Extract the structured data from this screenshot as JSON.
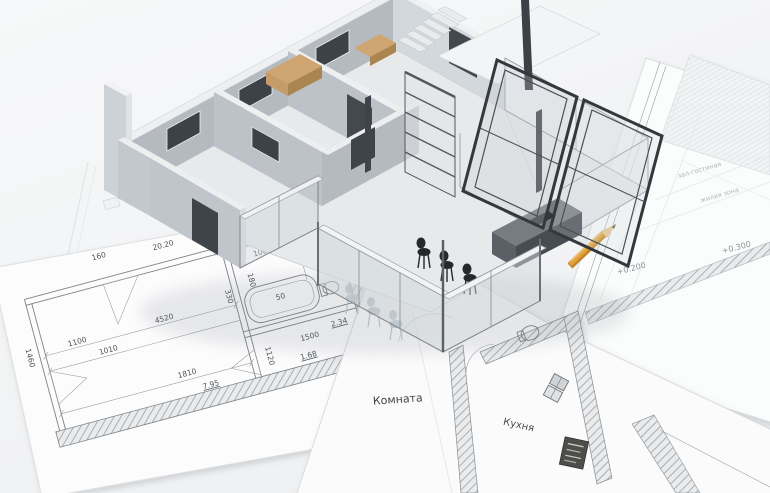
{
  "scene": {
    "colors": {
      "background": "#f4f5f6",
      "paper": "#fcfcfc",
      "plan-line": "#7d8286",
      "wall-gray": "#b4bac0",
      "wall-light": "#d3d8dc",
      "wall-top": "#edeff1",
      "window-dark": "#3d4248",
      "cabinet-tan": "#c59c68",
      "glass": "#cdd4d9",
      "frame-dark": "#34383c",
      "stool-black": "#26292c",
      "pencil-orange": "#e2a23c"
    }
  },
  "plans": {
    "left": {
      "dims": [
        "1460",
        "160",
        "20.20",
        "1100",
        "4520",
        "1010",
        "330",
        "1810",
        "7.95",
        "1120",
        "1500",
        "1.68",
        "900",
        "100",
        "50",
        "1.95",
        "180",
        "600",
        "400",
        "50",
        "2.34"
      ]
    },
    "center": {
      "room_label": "Комната",
      "kitchen_label": "Кухня"
    },
    "right": {
      "labels": [
        "зал-гостиная",
        "жилая зона"
      ],
      "elevations": [
        "+0.300",
        "+0.200"
      ]
    }
  }
}
